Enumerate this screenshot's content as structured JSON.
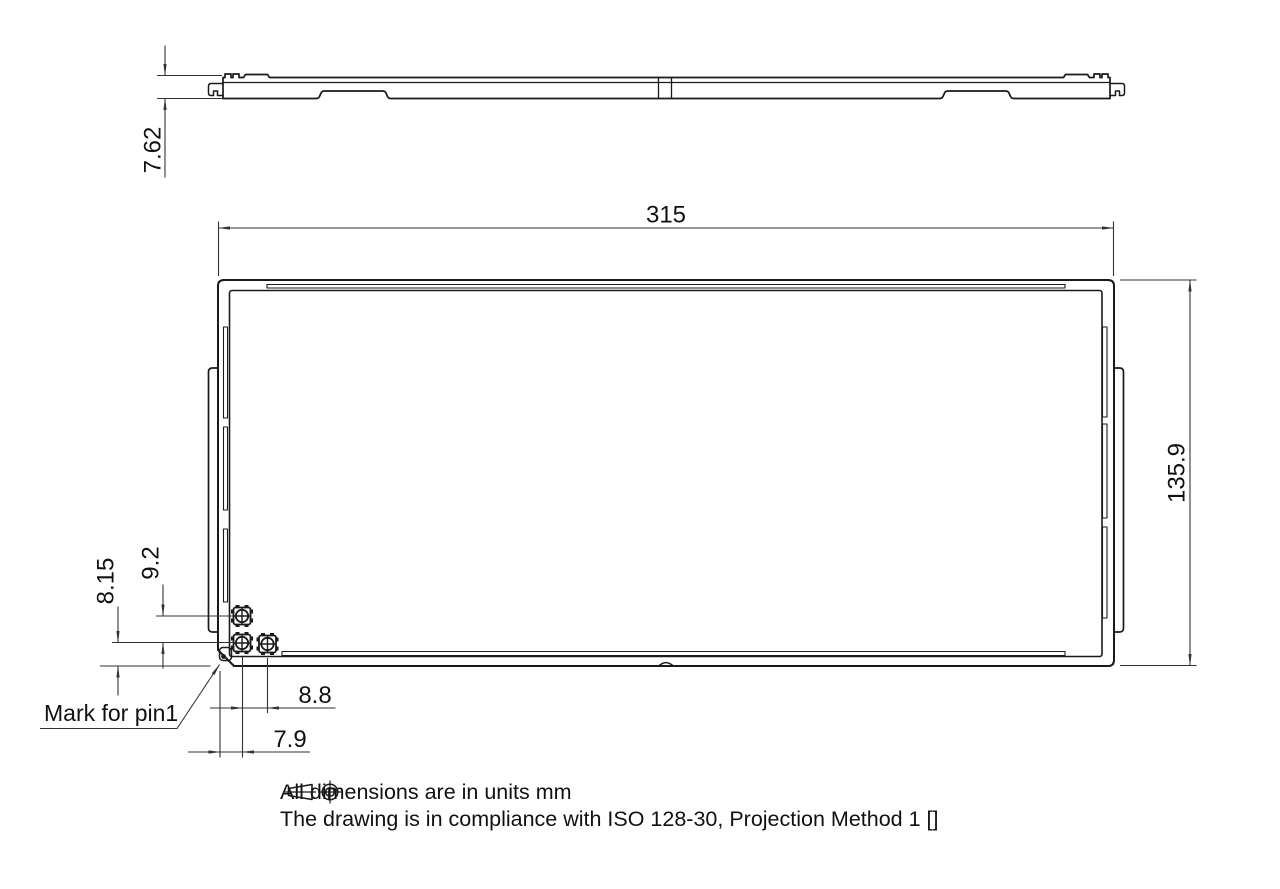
{
  "drawing": {
    "dimensions": {
      "side_thickness": "7.62",
      "overall_width": "315",
      "overall_height": "135.9",
      "pin_row_vertical_pitch": "9.2",
      "pin_row_bottom_offset": "8.15",
      "pin_horizontal_pitch": "8.8",
      "pin_left_offset": "7.9"
    },
    "labels": {
      "pin1_mark": "Mark for pin1"
    },
    "notes": {
      "line1": "All dimensions are in units mm",
      "line2_prefix": "The drawing is in compliance with ISO 128-30, Projection Method 1 [",
      "line2_suffix": "]"
    },
    "colors": {
      "object_line": "#1a1a1a",
      "dimension_line": "#333333",
      "background": "#ffffff"
    }
  }
}
